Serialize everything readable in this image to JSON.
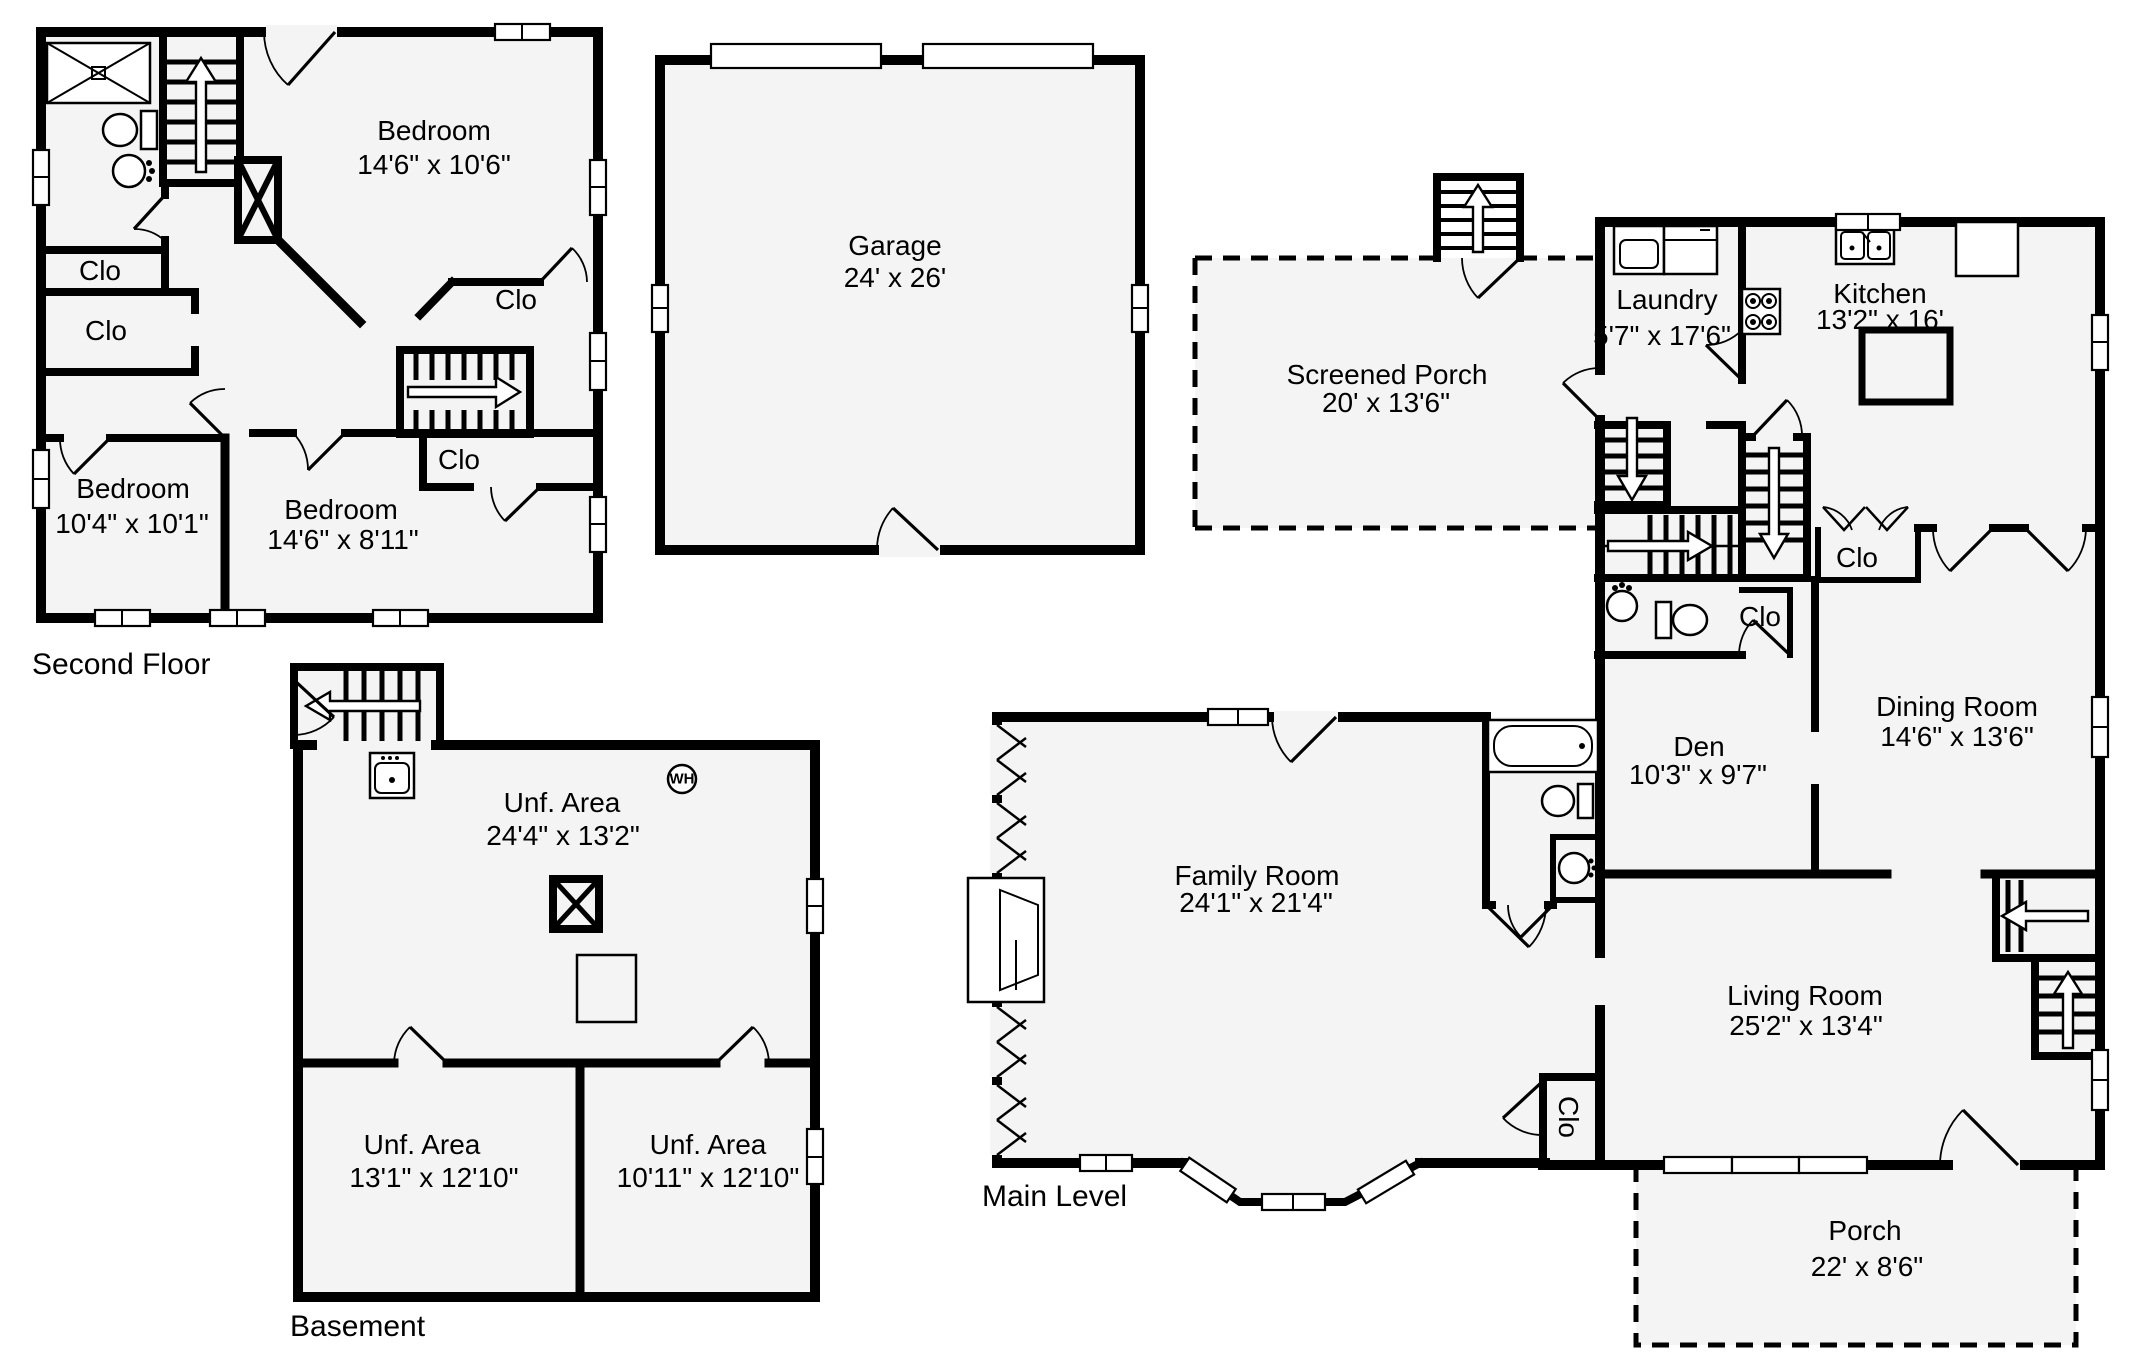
{
  "colors": {
    "wall": "#000000",
    "floor": "#f4f4f4",
    "background": "#ffffff"
  },
  "second_floor": {
    "caption": "Second Floor",
    "bedroom1": {
      "name": "Bedroom",
      "dims": "14'6\" x 10'6\""
    },
    "bedroom2": {
      "name": "Bedroom",
      "dims": "10'4\" x 10'1\""
    },
    "bedroom3": {
      "name": "Bedroom",
      "dims": "14'6\" x 8'11\""
    },
    "closet1": "Clo",
    "closet2": "Clo",
    "closet3": "Clo",
    "closet4": "Clo"
  },
  "garage": {
    "name": "Garage",
    "dims": "24' x 26'"
  },
  "main_level": {
    "caption": "Main Level",
    "screened_porch": {
      "name": "Screened Porch",
      "dims": "20' x 13'6\""
    },
    "laundry": {
      "name": "Laundry",
      "dims": "5'7\" x 17'6\""
    },
    "kitchen": {
      "name": "Kitchen",
      "dims": "13'2\" x 16'"
    },
    "den": {
      "name": "Den",
      "dims": "10'3\" x 9'7\""
    },
    "dining_room": {
      "name": "Dining Room",
      "dims": "14'6\" x 13'6\""
    },
    "family_room": {
      "name": "Family Room",
      "dims": "24'1\" x 21'4\""
    },
    "living_room": {
      "name": "Living Room",
      "dims": "25'2\" x 13'4\""
    },
    "porch": {
      "name": "Porch",
      "dims": "22' x 8'6\""
    },
    "closet_hall": "Clo",
    "closet_den": "Clo",
    "closet_family": "Clo"
  },
  "basement": {
    "caption": "Basement",
    "unf_area1": {
      "name": "Unf. Area",
      "dims": "24'4\" x 13'2\""
    },
    "unf_area2": {
      "name": "Unf. Area",
      "dims": "13'1\" x 12'10\""
    },
    "unf_area3": {
      "name": "Unf. Area",
      "dims": "10'11\" x 12'10\""
    },
    "water_heater_label": "WH"
  }
}
